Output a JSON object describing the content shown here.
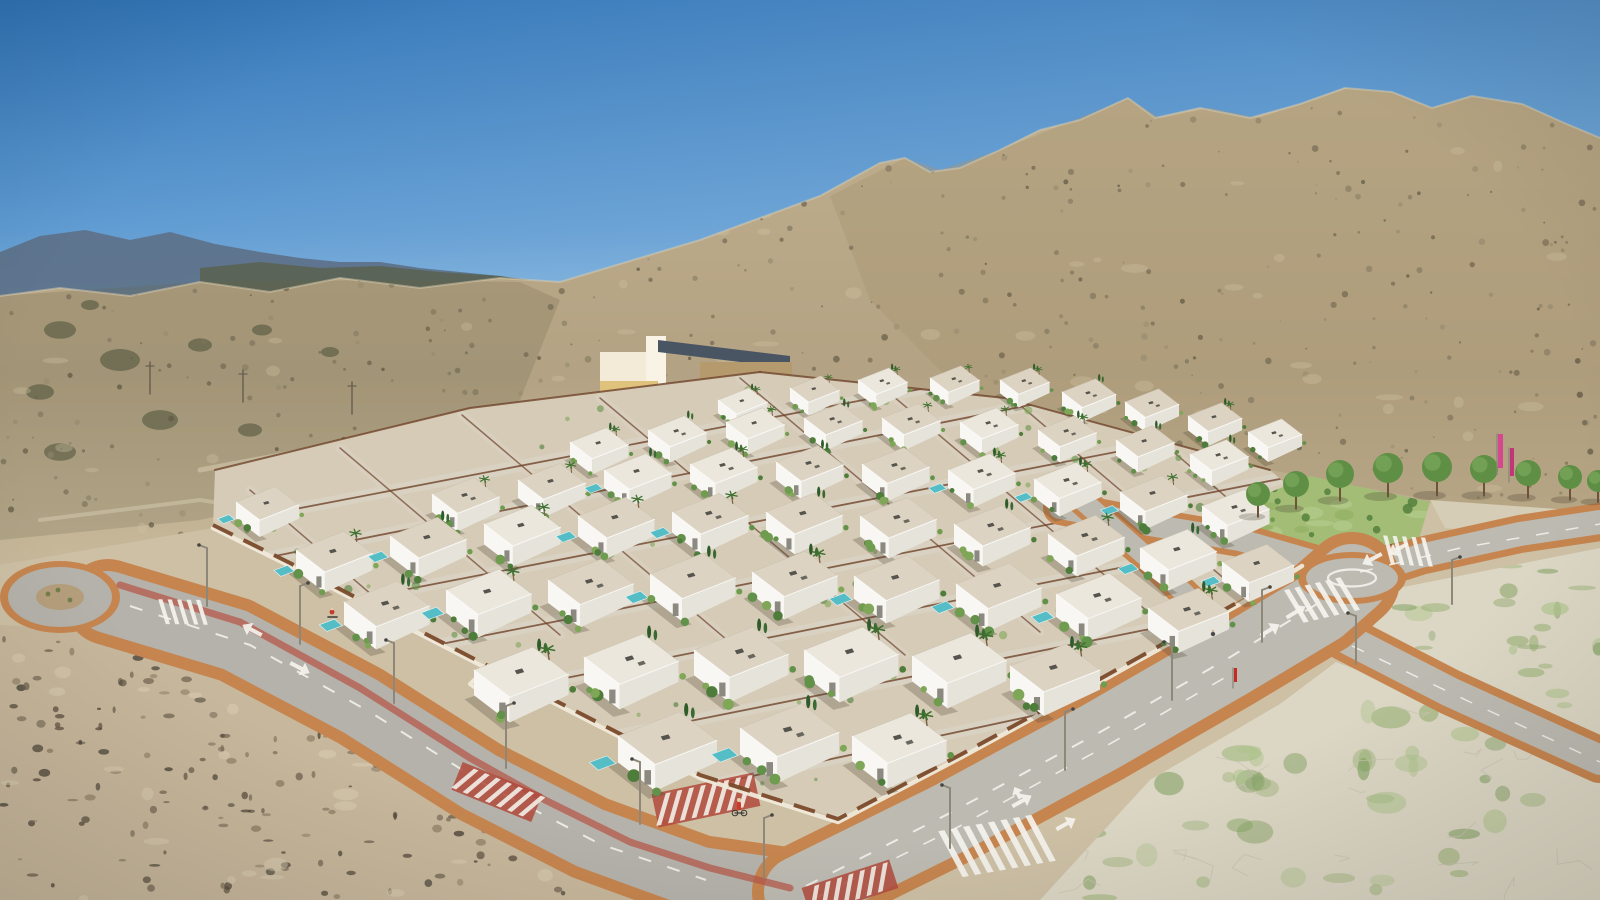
{
  "scene": {
    "title": "aerial-render-villa-development",
    "description": "Aerial 3D render of a new-build residential development of white flat-roof villas with pools in an arid mountain valley, with roads, roundabouts, crosswalks, vacant plots and scrubland.",
    "time_of_day": "clear sunny day"
  },
  "palette": {
    "sky_top": "#2f74b8",
    "sky_mid": "#5f9bd2",
    "sky_horizon": "#aacfe8",
    "far_mountain": "#5d7189",
    "far_ridge": "#59614f",
    "hill_base": "#b3a283",
    "hill_light": "#cfc2a4",
    "hill_dark": "#6b6248",
    "right_mountain": "#a99673",
    "ground": "#cdc0a5",
    "lot_pale": "#dcd6c4",
    "lot_green": "#9cb478",
    "lot_crack": "#c9c3b0",
    "scrub_base": "#c7b79c",
    "scrub_dark": "#55493a",
    "road_asphalt": "#b4b2aa",
    "road_asphalt2": "#bcbab1",
    "sidewalk": "#c6854f",
    "marking_white": "#f4f3ee",
    "bike_path": "#b55a4b",
    "crossing_red": "#b04a3c",
    "dev_base": "#d5cbb6",
    "street_light_tone": "#d9d2c2",
    "fence_corten": "#6f432a",
    "wall_white": "#f0e9d9",
    "wall_corten": "#7a4a2b",
    "villa_roof": "#dcd3c2",
    "villa_roof_light": "#ebe7dc",
    "villa_front": "#f8f7f3",
    "villa_side": "#e6e3da",
    "pool": "#55bdc6",
    "lawn": "#a3bd77",
    "tree_canopy": "#5e8f45",
    "tree_canopy_light": "#76a558",
    "trunk": "#6d5339",
    "flag_pink": "#d6478f",
    "flag_pink2": "#c23578",
    "building_roof": "#4a5563",
    "building_wall": "#f3ead7"
  },
  "geometry": {
    "ridge": [
      [
        0,
        296
      ],
      [
        60,
        288
      ],
      [
        130,
        296
      ],
      [
        200,
        282
      ],
      [
        270,
        292
      ],
      [
        340,
        278
      ],
      [
        420,
        288
      ],
      [
        500,
        278
      ],
      [
        560,
        282
      ],
      [
        640,
        258
      ],
      [
        700,
        240
      ],
      [
        760,
        218
      ],
      [
        820,
        196
      ],
      [
        880,
        163
      ],
      [
        905,
        158
      ],
      [
        930,
        172
      ],
      [
        960,
        168
      ],
      [
        1000,
        150
      ],
      [
        1040,
        130
      ],
      [
        1080,
        120
      ],
      [
        1128,
        98
      ],
      [
        1155,
        118
      ],
      [
        1200,
        108
      ],
      [
        1250,
        118
      ],
      [
        1300,
        104
      ],
      [
        1345,
        88
      ],
      [
        1392,
        92
      ],
      [
        1432,
        108
      ],
      [
        1472,
        96
      ],
      [
        1522,
        104
      ],
      [
        1562,
        122
      ],
      [
        1600,
        138
      ]
    ],
    "hill_bottom": [
      [
        1600,
        524
      ],
      [
        1430,
        500
      ],
      [
        1270,
        470
      ],
      [
        1005,
        398
      ],
      [
        760,
        372
      ],
      [
        470,
        408
      ],
      [
        213,
        528
      ],
      [
        0,
        565
      ]
    ],
    "far_mountains": [
      [
        0,
        252
      ],
      [
        40,
        236
      ],
      [
        85,
        230
      ],
      [
        130,
        240
      ],
      [
        170,
        232
      ],
      [
        215,
        244
      ],
      [
        260,
        252
      ],
      [
        300,
        258
      ],
      [
        340,
        262
      ],
      [
        380,
        262
      ],
      [
        420,
        268
      ],
      [
        460,
        272
      ],
      [
        500,
        276
      ],
      [
        540,
        282
      ],
      [
        560,
        290
      ],
      [
        560,
        330
      ],
      [
        0,
        330
      ]
    ],
    "far_ridge2": [
      [
        200,
        268
      ],
      [
        260,
        262
      ],
      [
        320,
        268
      ],
      [
        380,
        266
      ],
      [
        440,
        272
      ],
      [
        500,
        276
      ],
      [
        545,
        282
      ],
      [
        575,
        290
      ],
      [
        575,
        330
      ],
      [
        200,
        330
      ]
    ],
    "dev": [
      [
        213,
        528
      ],
      [
        215,
        470
      ],
      [
        470,
        408
      ],
      [
        760,
        372
      ],
      [
        1005,
        398
      ],
      [
        1270,
        470
      ],
      [
        1332,
        524
      ],
      [
        1300,
        566
      ],
      [
        1240,
        602
      ],
      [
        1100,
        680
      ],
      [
        958,
        757
      ],
      [
        845,
        820
      ],
      [
        700,
        776
      ],
      [
        558,
        702
      ],
      [
        418,
        630
      ],
      [
        288,
        564
      ]
    ],
    "park": [
      [
        1242,
        540
      ],
      [
        1256,
        498
      ],
      [
        1310,
        476
      ],
      [
        1430,
        502
      ],
      [
        1418,
        542
      ],
      [
        1330,
        560
      ],
      [
        1262,
        556
      ]
    ],
    "lotA": [
      [
        1040,
        900
      ],
      [
        1150,
        780
      ],
      [
        1280,
        704
      ],
      [
        1336,
        662
      ],
      [
        1410,
        690
      ],
      [
        1530,
        744
      ],
      [
        1600,
        776
      ],
      [
        1600,
        900
      ]
    ],
    "lotB": [
      [
        1430,
        500
      ],
      [
        1600,
        512
      ],
      [
        1600,
        540
      ],
      [
        1445,
        528
      ]
    ],
    "lotC": [
      [
        1388,
        590
      ],
      [
        1600,
        548
      ],
      [
        1600,
        740
      ],
      [
        1460,
        676
      ],
      [
        1372,
        630
      ]
    ],
    "scrub": [
      [
        0,
        625
      ],
      [
        230,
        638
      ],
      [
        330,
        680
      ],
      [
        460,
        750
      ],
      [
        600,
        822
      ],
      [
        700,
        868
      ],
      [
        760,
        900
      ],
      [
        0,
        900
      ]
    ],
    "left_hill_shade": [
      [
        0,
        296
      ],
      [
        200,
        282
      ],
      [
        380,
        280
      ],
      [
        520,
        282
      ],
      [
        560,
        300
      ],
      [
        520,
        400
      ],
      [
        380,
        480
      ],
      [
        200,
        520
      ],
      [
        0,
        540
      ]
    ],
    "right_mtn_shade": [
      [
        830,
        196
      ],
      [
        905,
        158
      ],
      [
        940,
        170
      ],
      [
        1000,
        150
      ],
      [
        1060,
        126
      ],
      [
        1128,
        98
      ],
      [
        1160,
        118
      ],
      [
        1210,
        108
      ],
      [
        1258,
        118
      ],
      [
        1302,
        104
      ],
      [
        1348,
        88
      ],
      [
        1392,
        92
      ],
      [
        1432,
        108
      ],
      [
        1472,
        96
      ],
      [
        1522,
        104
      ],
      [
        1562,
        122
      ],
      [
        1600,
        138
      ],
      [
        1600,
        520
      ],
      [
        1400,
        500
      ],
      [
        1200,
        470
      ],
      [
        1000,
        430
      ],
      [
        870,
        300
      ]
    ]
  },
  "roads": {
    "boulevard_sw": {
      "pts": [
        [
          108,
          602
        ],
        [
          235,
          640
        ],
        [
          360,
          706
        ],
        [
          480,
          782
        ],
        [
          590,
          838
        ],
        [
          700,
          878
        ],
        [
          800,
          892
        ]
      ],
      "side": 86,
      "asph": 62
    },
    "boulevard_ne": {
      "pts": [
        [
          800,
          892
        ],
        [
          950,
          818
        ],
        [
          1100,
          737
        ],
        [
          1230,
          662
        ],
        [
          1320,
          608
        ],
        [
          1352,
          580
        ]
      ],
      "side": 96,
      "asph": 72
    },
    "ne_exit": {
      "pts": [
        [
          1352,
          578
        ],
        [
          1420,
          556
        ],
        [
          1520,
          534
        ],
        [
          1600,
          522
        ]
      ],
      "side": 38,
      "asph": 24
    },
    "se_branch": {
      "pts": [
        [
          1345,
          638
        ],
        [
          1450,
          692
        ],
        [
          1560,
          742
        ],
        [
          1600,
          760
        ]
      ],
      "side": 46,
      "asph": 30
    },
    "nw_park_arm": {
      "pts": [
        [
          1330,
          566
        ],
        [
          1240,
          540
        ],
        [
          1150,
          525
        ],
        [
          1060,
          508
        ]
      ],
      "side": 34,
      "asph": 22
    },
    "internal_entry": {
      "pts": [
        [
          1245,
          652
        ],
        [
          1150,
          560
        ],
        [
          1082,
          500
        ]
      ],
      "side": 30,
      "asph": 20
    },
    "bike_path": [
      [
        120,
        585
      ],
      [
        240,
        622
      ],
      [
        360,
        688
      ],
      [
        470,
        758
      ],
      [
        545,
        800
      ],
      [
        630,
        842
      ],
      [
        710,
        868
      ],
      [
        790,
        888
      ]
    ]
  },
  "roundabouts": {
    "left": {
      "cx": 60,
      "cy": 597,
      "rx_side": 60,
      "ry_side": 36,
      "rx": 52,
      "ry": 30,
      "island_rx": 24,
      "island_ry": 13
    },
    "right": {
      "cx": 1352,
      "cy": 578,
      "rx_side": 54,
      "ry_side": 26,
      "rx": 46,
      "ry": 20,
      "paint_rx": 24,
      "paint_ry": 8.5
    }
  },
  "markings": {
    "zebras": [
      {
        "x": 997,
        "y": 846,
        "a": -28,
        "n": 8,
        "step": 12,
        "len": 52,
        "w": 6
      },
      {
        "x": 1322,
        "y": 600,
        "a": -31,
        "n": 6,
        "step": 10,
        "len": 38,
        "w": 5
      },
      {
        "x": 1408,
        "y": 551,
        "a": -15,
        "n": 5,
        "step": 9,
        "len": 30,
        "w": 4
      },
      {
        "x": 183,
        "y": 612,
        "a": -17,
        "n": 5,
        "step": 9,
        "len": 26,
        "w": 4
      }
    ],
    "red_crossings": [
      {
        "x": 497,
        "y": 792,
        "a": 22,
        "w": 86,
        "h": 30
      },
      {
        "x": 706,
        "y": 800,
        "a": -12,
        "w": 104,
        "h": 34
      },
      {
        "x": 850,
        "y": 888,
        "a": -18,
        "w": 92,
        "h": 30
      }
    ],
    "arrows": [
      {
        "x": 300,
        "y": 668,
        "a": 28,
        "t": "s"
      },
      {
        "x": 252,
        "y": 630,
        "a": 208,
        "t": "s"
      },
      {
        "x": 1022,
        "y": 801,
        "a": -29,
        "t": "l"
      },
      {
        "x": 1066,
        "y": 824,
        "a": -29,
        "t": "s"
      },
      {
        "x": 1270,
        "y": 630,
        "a": -31,
        "t": "s"
      },
      {
        "x": 1296,
        "y": 612,
        "a": -31,
        "t": "s"
      },
      {
        "x": 1372,
        "y": 559,
        "a": 152,
        "t": "s"
      },
      {
        "x": 1398,
        "y": 549,
        "a": 152,
        "t": "s"
      }
    ],
    "dashes": [
      {
        "pts": [
          [
            130,
            606
          ],
          [
            250,
            645
          ],
          [
            370,
            712
          ],
          [
            488,
            786
          ],
          [
            600,
            844
          ],
          [
            706,
            880
          ]
        ],
        "w": 2
      },
      {
        "pts": [
          [
            806,
            886
          ],
          [
            952,
            812
          ],
          [
            1102,
            731
          ],
          [
            1232,
            656
          ],
          [
            1330,
            596
          ]
        ],
        "w": 2
      },
      {
        "pts": [
          [
            816,
            898
          ],
          [
            960,
            826
          ],
          [
            1108,
            745
          ],
          [
            1238,
            670
          ]
        ],
        "w": 1.6
      },
      {
        "pts": [
          [
            1360,
            572
          ],
          [
            1460,
            548
          ],
          [
            1600,
            524
          ]
        ],
        "w": 1.5
      },
      {
        "pts": [
          [
            1352,
            646
          ],
          [
            1470,
            702
          ],
          [
            1600,
            762
          ]
        ],
        "w": 1.5
      }
    ]
  },
  "fences_row": [
    [
      238,
      520,
      1030,
      368
    ],
    [
      255,
      560,
      1180,
      375
    ],
    [
      300,
      610,
      1255,
      425
    ],
    [
      360,
      660,
      1300,
      475
    ],
    [
      430,
      705,
      1310,
      530
    ],
    [
      520,
      755,
      1280,
      603
    ],
    [
      640,
      800,
      1200,
      680
    ],
    [
      758,
      838,
      1085,
      768
    ]
  ],
  "fences_cross": [
    [
      462,
      415,
      760,
      668
    ],
    [
      600,
      398,
      905,
      655
    ],
    [
      740,
      378,
      1040,
      632
    ],
    [
      880,
      385,
      1160,
      622
    ],
    [
      1020,
      405,
      1240,
      592
    ],
    [
      1150,
      432,
      1300,
      560
    ],
    [
      340,
      448,
      560,
      635
    ],
    [
      250,
      490,
      430,
      645
    ]
  ],
  "villas": [
    [
      718,
      400,
      0.55
    ],
    [
      790,
      388,
      0.55
    ],
    [
      858,
      380,
      0.55
    ],
    [
      930,
      378,
      0.55
    ],
    [
      1000,
      380,
      0.55
    ],
    [
      1062,
      392,
      0.6
    ],
    [
      1125,
      402,
      0.6
    ],
    [
      1188,
      416,
      0.6
    ],
    [
      1248,
      432,
      0.6
    ],
    [
      570,
      442,
      0.65
    ],
    [
      648,
      430,
      0.65
    ],
    [
      726,
      422,
      0.65
    ],
    [
      804,
      418,
      0.65
    ],
    [
      882,
      418,
      0.65
    ],
    [
      960,
      422,
      0.65
    ],
    [
      1038,
      430,
      0.65
    ],
    [
      1116,
      440,
      0.65
    ],
    [
      1190,
      454,
      0.65
    ],
    [
      432,
      494,
      0.75
    ],
    [
      518,
      480,
      0.75
    ],
    [
      604,
      470,
      0.75
    ],
    [
      690,
      464,
      0.75
    ],
    [
      776,
      462,
      0.75
    ],
    [
      862,
      464,
      0.75
    ],
    [
      948,
      470,
      0.75
    ],
    [
      1034,
      479,
      0.75
    ],
    [
      1120,
      492,
      0.75
    ],
    [
      1202,
      506,
      0.75
    ],
    [
      296,
      550,
      0.85
    ],
    [
      390,
      536,
      0.85
    ],
    [
      484,
      524,
      0.85
    ],
    [
      578,
      516,
      0.85
    ],
    [
      672,
      512,
      0.85
    ],
    [
      766,
      512,
      0.85
    ],
    [
      860,
      516,
      0.85
    ],
    [
      954,
      524,
      0.85
    ],
    [
      1048,
      534,
      0.85
    ],
    [
      1140,
      548,
      0.85
    ],
    [
      1222,
      562,
      0.8
    ],
    [
      236,
      502,
      0.7
    ],
    [
      344,
      602,
      0.95
    ],
    [
      446,
      590,
      0.95
    ],
    [
      548,
      580,
      0.95
    ],
    [
      650,
      574,
      0.95
    ],
    [
      752,
      572,
      0.95
    ],
    [
      854,
      576,
      0.95
    ],
    [
      956,
      584,
      0.95
    ],
    [
      1056,
      594,
      0.95
    ],
    [
      1148,
      608,
      0.9
    ],
    [
      474,
      670,
      1.05
    ],
    [
      584,
      657,
      1.05
    ],
    [
      694,
      650,
      1.05
    ],
    [
      804,
      650,
      1.05
    ],
    [
      912,
      656,
      1.05
    ],
    [
      1010,
      666,
      1.0
    ],
    [
      618,
      736,
      1.1
    ],
    [
      740,
      728,
      1.1
    ],
    [
      852,
      736,
      1.05
    ]
  ],
  "trees": [
    [
      1258,
      494,
      12
    ],
    [
      1296,
      484,
      13
    ],
    [
      1340,
      474,
      14
    ],
    [
      1388,
      468,
      15
    ],
    [
      1437,
      467,
      15
    ],
    [
      1484,
      469,
      14
    ],
    [
      1528,
      473,
      13
    ],
    [
      1570,
      477,
      12
    ],
    [
      1598,
      481,
      11
    ]
  ],
  "street_lights": [
    [
      207,
      548,
      58
    ],
    [
      300,
      586,
      58
    ],
    [
      394,
      643,
      60
    ],
    [
      506,
      706,
      62
    ],
    [
      640,
      762,
      62
    ],
    [
      764,
      818,
      60
    ],
    [
      950,
      788,
      60
    ],
    [
      1065,
      712,
      58
    ],
    [
      1172,
      645,
      55
    ],
    [
      1262,
      590,
      52
    ],
    [
      1356,
      616,
      48
    ],
    [
      1452,
      560,
      44
    ]
  ],
  "flags": [
    {
      "x": 1497,
      "y": 434,
      "h": 34,
      "w": 5,
      "color": "#d6478f"
    },
    {
      "x": 1509,
      "y": 448,
      "h": 28,
      "w": 4,
      "color": "#c23578"
    },
    {
      "x": 1233,
      "y": 668,
      "h": 14,
      "w": 3,
      "color": "#c62a22"
    }
  ],
  "people": [
    {
      "type": "cyclist",
      "x": 332,
      "y": 612
    },
    {
      "type": "pedestrian-with-bike",
      "x": 739,
      "y": 804
    },
    {
      "type": "pedestrian",
      "x": 1213,
      "y": 634
    }
  ],
  "building": {
    "x": 600,
    "y": 336,
    "label": "cream warehouse with dark roof"
  },
  "power_poles": [
    [
      150,
      362
    ],
    [
      243,
      370
    ],
    [
      352,
      382
    ]
  ],
  "speckles": {
    "hill_dark_n": 650,
    "hill_light_n": 70,
    "scrub_n": 300,
    "lotA_green_n": 64,
    "lotC_green_n": 34,
    "crack_n": 22
  }
}
